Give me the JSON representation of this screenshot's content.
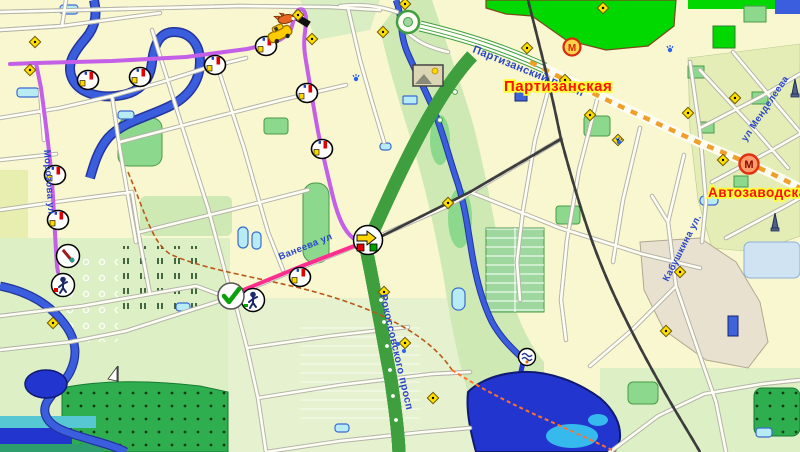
{
  "metro_stations": [
    {
      "label": "Партизанская",
      "marker_letter": "М",
      "label_color": "#ff1010",
      "halo_color": "#ffff33"
    },
    {
      "label": "Автозаводская",
      "marker_letter": "М",
      "label_color": "#ff1010",
      "halo_color": "#ffff33"
    }
  ],
  "street_labels": [
    {
      "id": "partizansky",
      "text": "Партизанский просп"
    },
    {
      "id": "rokossovskogo",
      "text": "Рокоссовского просп"
    },
    {
      "id": "kabushkina",
      "text": "Кабушкина ул."
    },
    {
      "id": "mendeleeva",
      "text": "ул Менделеева"
    },
    {
      "id": "vaneeva",
      "text": "Ванеева ул"
    },
    {
      "id": "morozova",
      "text": "Морозова ул"
    }
  ],
  "routes": {
    "planned_color": "#c45fe8",
    "active_color": "#ff2d8e"
  },
  "map_colors": {
    "background": "#f9f7cf",
    "forest_bright": "#00d800",
    "park_green": "#8cd88c",
    "pale_green": "#ddefc4",
    "water_blue": "#3b5ede",
    "lake_deep": "#2335cf",
    "pond_cyan": "#b8ecf4",
    "highway_dash": "#f0a028",
    "residential_olive": "#e4edb6",
    "industrial_tan": "#e9e1d0"
  },
  "icons": [
    "waypoint-icon",
    "person-icon",
    "tool-icon",
    "checkpoint-icon",
    "turn-arrow-icon",
    "vehicle-icon",
    "animal-icon",
    "photo-icon",
    "metro-m-icon",
    "monument-icon",
    "fountain-icon",
    "road-marker-diamond-icon",
    "sailboat-icon",
    "dam-icon"
  ]
}
